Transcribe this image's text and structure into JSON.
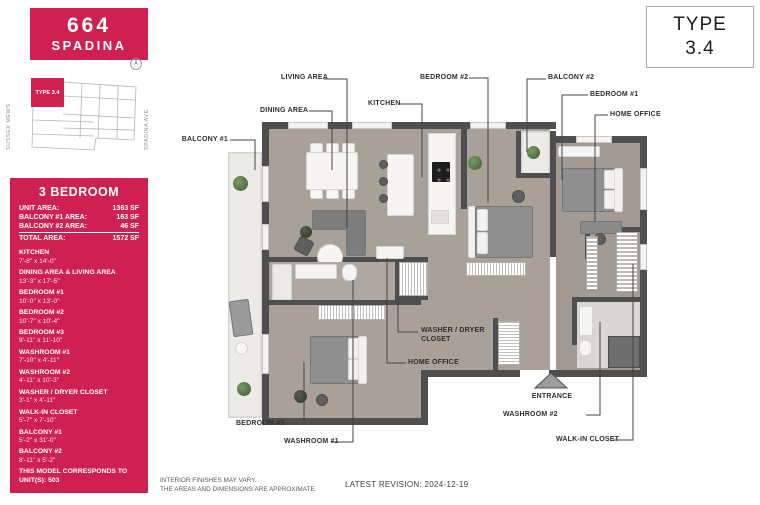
{
  "colors": {
    "accent": "#CF2151",
    "wall": "#4f4f4f",
    "floor": "#a9a198",
    "balcony": "#ecebe8"
  },
  "brand": {
    "number": "664",
    "name": "SPADINA"
  },
  "type_box": {
    "line1": "TYPE",
    "line2": "3.4"
  },
  "keyplan": {
    "highlight_label": "TYPE 3.4",
    "street_left": "SUSSEX MEWS",
    "street_right": "SPADINA AVE"
  },
  "info_panel": {
    "title": "3 BEDROOM",
    "areas": [
      {
        "label": "UNIT AREA:",
        "value": "1363 SF"
      },
      {
        "label": "BALCONY #1 AREA:",
        "value": "163 SF"
      },
      {
        "label": "BALCONY #2 AREA:",
        "value": "46 SF"
      },
      {
        "label": "TOTAL AREA:",
        "value": "1572 SF"
      }
    ],
    "rooms": [
      {
        "name": "KITCHEN",
        "dims": "7'-8\" x 14'-0\""
      },
      {
        "name": "DINING AREA & LIVING AREA",
        "dims": "13'-3\" x 17'-5\""
      },
      {
        "name": "BEDROOM #1",
        "dims": "10'-0\" x 13'-0\""
      },
      {
        "name": "BEDROOM #2",
        "dims": "10'-7\" x 10'-4\""
      },
      {
        "name": "BEDROOM #3",
        "dims": "9'-11\" x 11'-10\""
      },
      {
        "name": "WASHROOM #1",
        "dims": "7'-10\" x 4'-11\""
      },
      {
        "name": "WASHROOM #2",
        "dims": "4'-11\" x 10'-3\""
      },
      {
        "name": "WASHER / DRYER CLOSET",
        "dims": "3'-1\" x 4'-11\""
      },
      {
        "name": "WALK-IN CLOSET",
        "dims": "5'-7\" x 7'-10\""
      },
      {
        "name": "BALCONY #1",
        "dims": "5'-2\" x 31'-0\""
      },
      {
        "name": "BALCONY #2",
        "dims": "8'-11\" x 5'-2\""
      }
    ],
    "footer": "THIS MODEL CORRESPONDS TO UNIT(S): 503"
  },
  "plan_labels": {
    "balcony1": "BALCONY #1",
    "dining": "DINING AREA",
    "living": "LIVING AREA",
    "kitchen": "KITCHEN",
    "bedroom2": "BEDROOM #2",
    "balcony2": "BALCONY #2",
    "bedroom1": "BEDROOM #1",
    "home_office_top": "HOME OFFICE",
    "washer_dryer_line1": "WASHER / DRYER",
    "washer_dryer_line2": "CLOSET",
    "home_office_bottom": "HOME OFFICE",
    "entrance": "ENTRANCE",
    "washroom2": "WASHROOM #2",
    "walk_in": "WALK-IN CLOSET",
    "bedroom3": "BEDROOM #3",
    "washroom1": "WASHROOM #1"
  },
  "footer": {
    "disclaimer_l1": "INTERIOR FINISHES MAY VARY.",
    "disclaimer_l2": "THE AREAS AND DIMENSIONS ARE APPROXIMATE.",
    "revision": "LATEST REVISION: 2024-12-19"
  }
}
